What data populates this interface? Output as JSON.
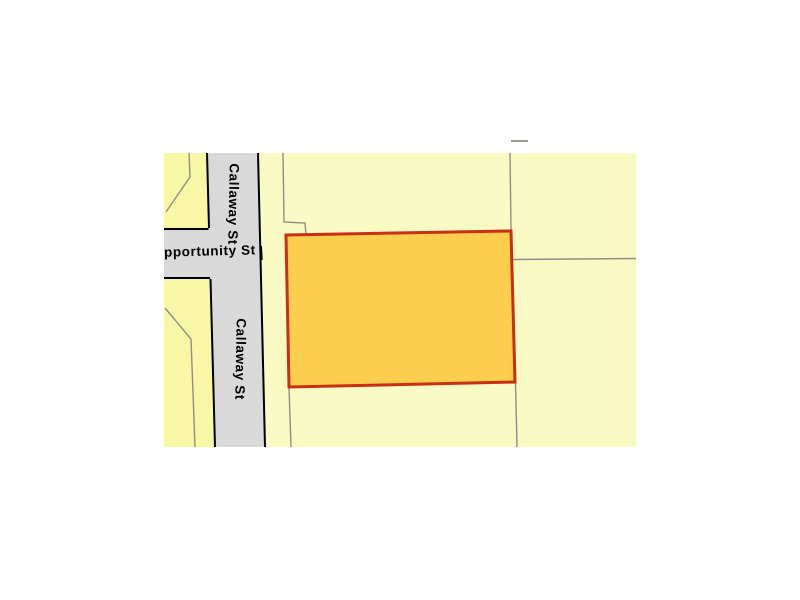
{
  "map": {
    "type": "parcel-map",
    "labels": {
      "callaway_upper": "Callaway St",
      "callaway_lower": "Callaway St",
      "opportunity": "Opportunity St"
    },
    "colors": {
      "background": "#ffffff",
      "parcel_east_fill": "#fafac5",
      "parcel_west_fill": "#f7f7a5",
      "street_fill": "#d9d9d9",
      "street_edge": "#000000",
      "parcel_boundary_line": "#8f8f85",
      "highlight_parcel_fill": "#fbce4e",
      "highlight_parcel_border": "#c92f16",
      "label_color": "#000000"
    }
  }
}
